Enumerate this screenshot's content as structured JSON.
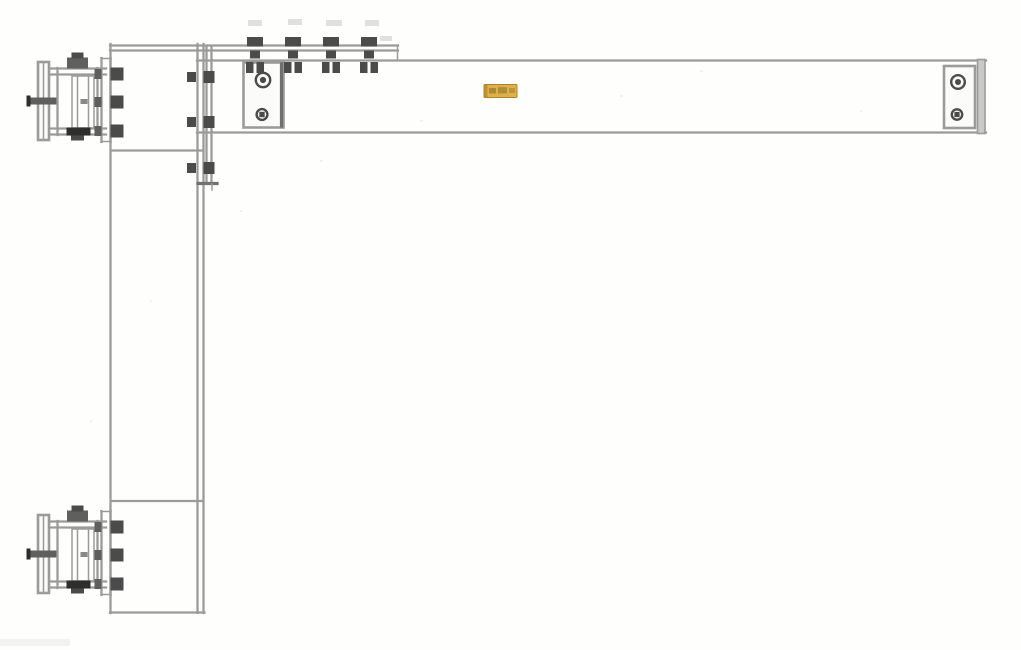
{
  "colors": {
    "background": "#fefefd",
    "line": "#9b9b99",
    "line_dark": "#707070",
    "bolt": "#4b4b4b",
    "bolt_dark": "#2e2e2e",
    "metal_mid": "#5f5f5f",
    "metal_fill": "#c9c9c7",
    "plate_fill": "#fbfbfa",
    "label_orange": "#ddb04a",
    "label_edge": "#b08427",
    "label_mark": "#7d621e"
  },
  "drawing": {
    "kind": "technical-drawing",
    "parts": [
      {
        "name": "vertical-column"
      },
      {
        "name": "horizontal-boom-beam"
      },
      {
        "name": "corner-connection-plate"
      },
      {
        "name": "top-clamp-plate"
      },
      {
        "name": "hanger-plate-left"
      },
      {
        "name": "boom-end-plate-right"
      },
      {
        "name": "orange-id-tag"
      },
      {
        "name": "upper-wall-pivot-bracket"
      },
      {
        "name": "lower-wall-pivot-bracket"
      }
    ]
  }
}
